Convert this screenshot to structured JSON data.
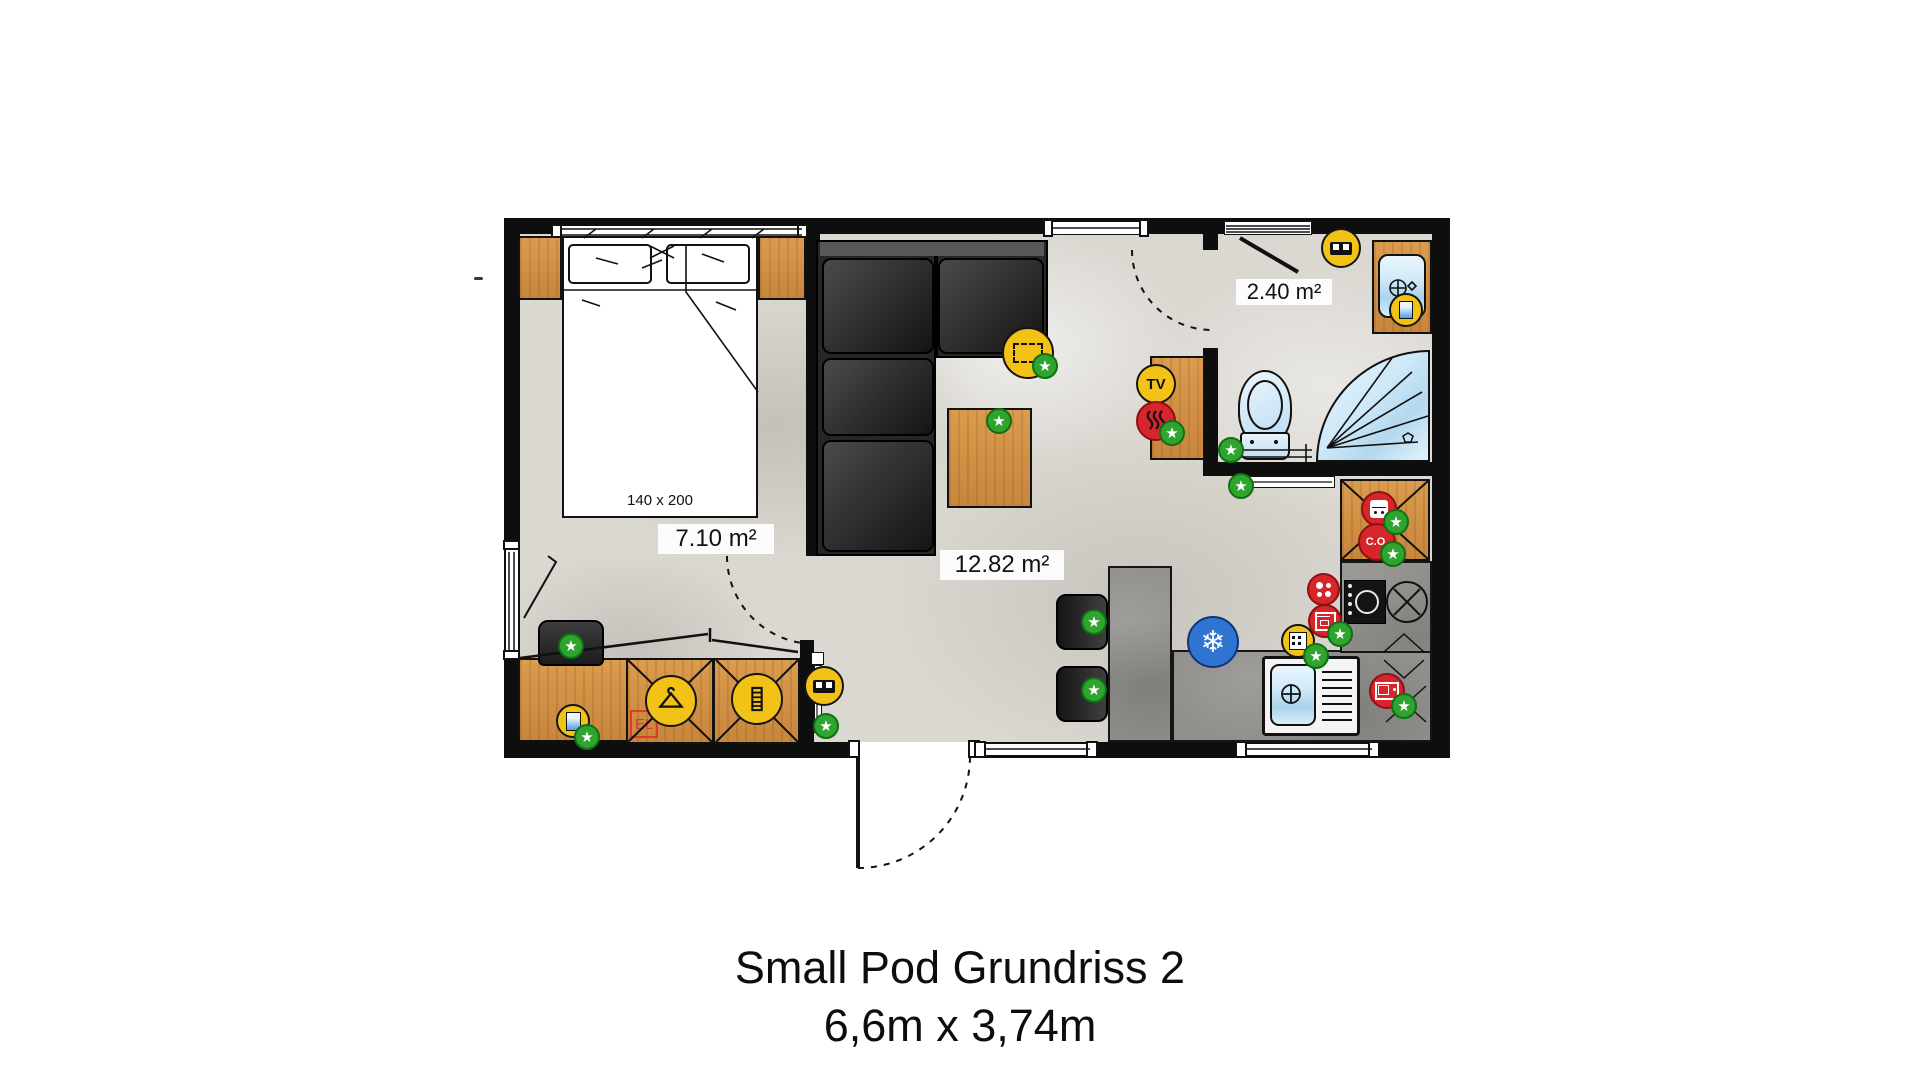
{
  "title": {
    "line1": "Small Pod Grundriss 2",
    "line2": "6,6m x 3,74m"
  },
  "labels": {
    "bedroom_area": "7.10 m²",
    "living_area": "12.82 m²",
    "bathroom_area": "2.40 m²",
    "bed_size": "140 x 200",
    "electric_panel": "EL",
    "tv": "TV",
    "co_detector": "C.O."
  },
  "glyphs": {
    "star": "★",
    "snowflake": "❄"
  },
  "colors": {
    "wall": "#0e0e0e",
    "wood": "#d2924a",
    "counter": "#92908c",
    "smart_green": "#2fa42f",
    "smart_yellow": "#f2c216",
    "smart_red": "#d6252b",
    "smart_blue": "#2f74d0",
    "water_fixture": "#cfe9f8"
  }
}
